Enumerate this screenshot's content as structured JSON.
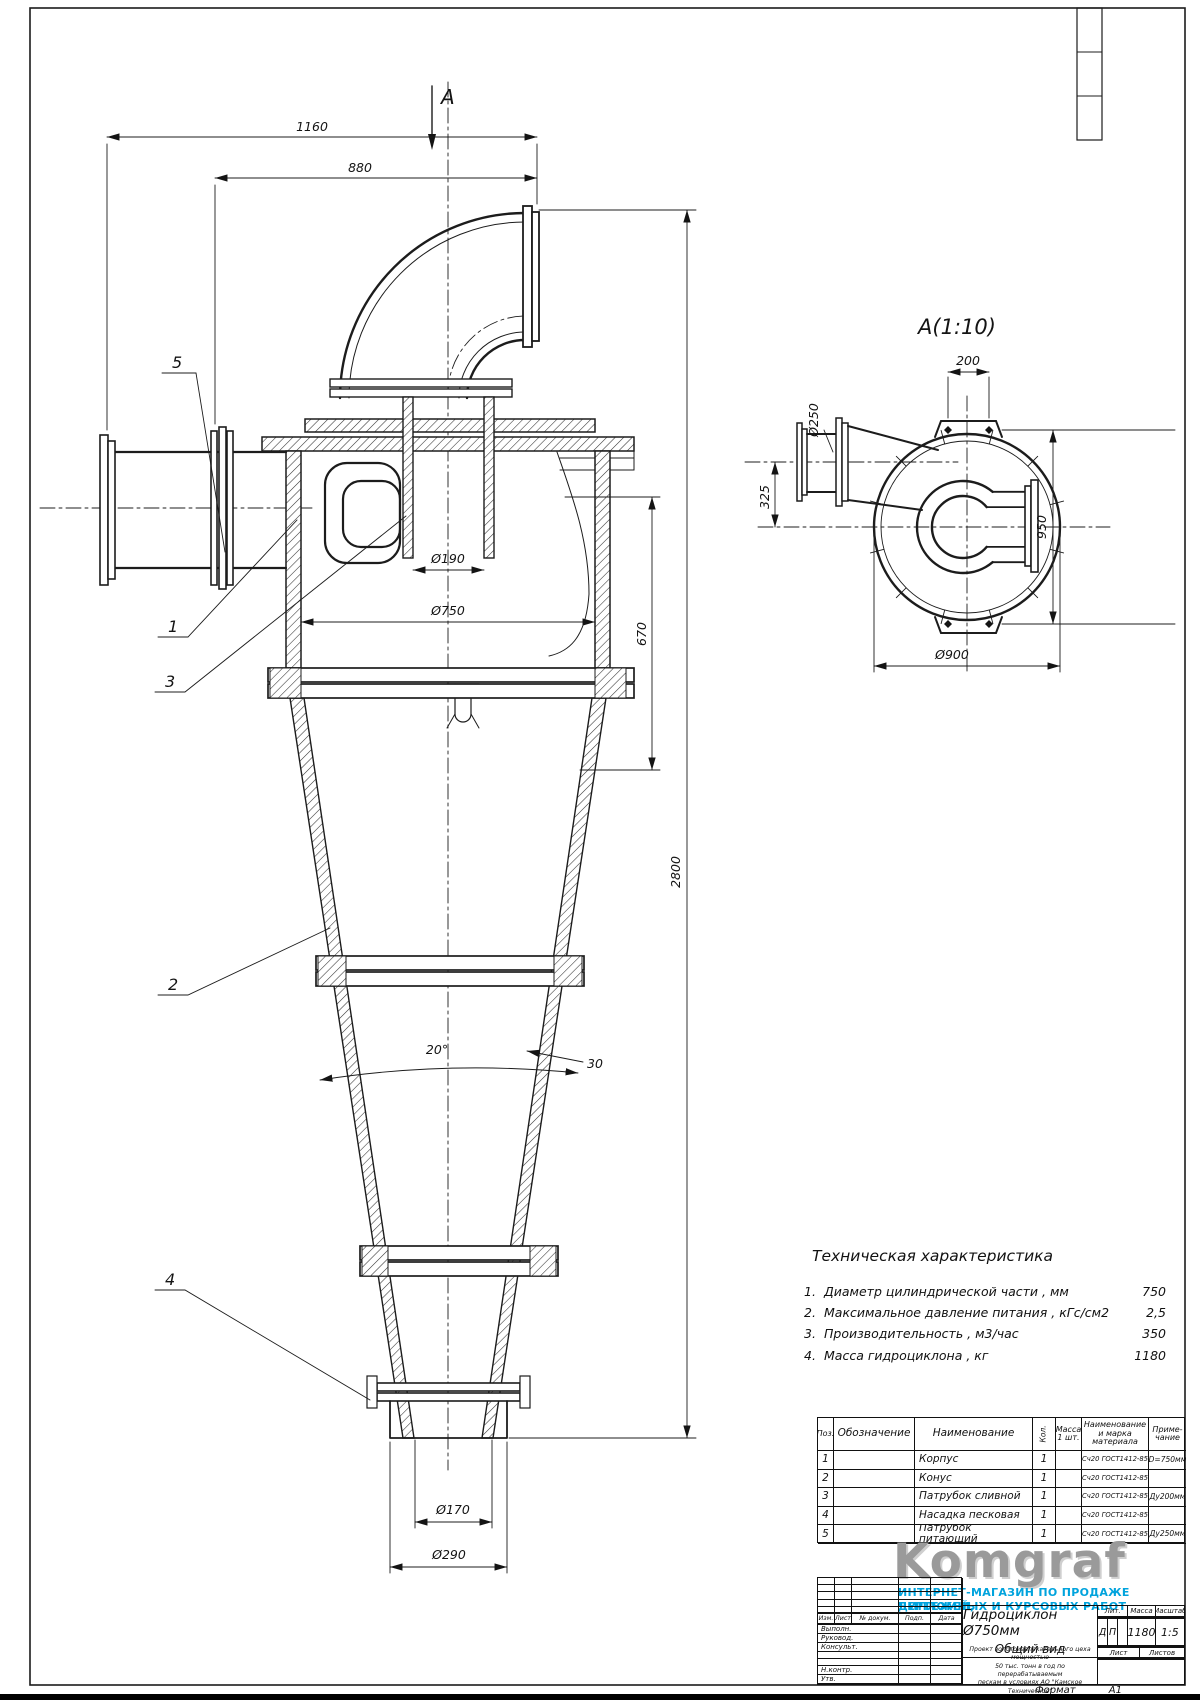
{
  "page": {
    "format_label": "Формат",
    "format_value": "А1"
  },
  "main_view": {
    "section_arrow_label": "А",
    "dims": {
      "w1160": "1160",
      "w880": "880",
      "d190": "Ø190",
      "d750": "Ø750",
      "h670": "670",
      "h2800": "2800",
      "angle": "20°",
      "t30": "30",
      "d170": "Ø170",
      "d290": "Ø290"
    },
    "callouts": {
      "c1": "1",
      "c2": "2",
      "c3": "3",
      "c4": "4",
      "c5": "5"
    }
  },
  "section_view": {
    "title": "А(1:10)",
    "dims": {
      "w200": "200",
      "d250": "Ø250",
      "h325": "325",
      "h950": "950",
      "d900": "Ø900"
    }
  },
  "tech_chars": {
    "title": "Техническая характеристика",
    "items": [
      {
        "num": "1.",
        "label": "Диаметр цилиндрической части , мм",
        "value": "750"
      },
      {
        "num": "2.",
        "label": "Максимальное давление питания , кГс/см2",
        "value": "2,5"
      },
      {
        "num": "3.",
        "label": "Производительность , м3/час",
        "value": "350"
      },
      {
        "num": "4.",
        "label": "Масса гидроциклона , кг",
        "value": "1180"
      }
    ]
  },
  "parts_table": {
    "headers": {
      "pos": "Поз.",
      "designation": "Обозначение",
      "name": "Наименование",
      "qty": "Кол.",
      "mass": "Масса 1 шт.",
      "material": "Наименование и марка материала",
      "note": "Приме- чание"
    },
    "rows": [
      {
        "pos": "1",
        "designation": "",
        "name": "Корпус",
        "qty": "1",
        "mass": "",
        "material": "Сч20 ГОСТ1412-85",
        "note": "D=750мм"
      },
      {
        "pos": "2",
        "designation": "",
        "name": "Конус",
        "qty": "1",
        "mass": "",
        "material": "Сч20 ГОСТ1412-85",
        "note": ""
      },
      {
        "pos": "3",
        "designation": "",
        "name": "Патрубок сливной",
        "qty": "1",
        "mass": "",
        "material": "Сч20 ГОСТ1412-85",
        "note": "Ду200мм"
      },
      {
        "pos": "4",
        "designation": "",
        "name": "Насадка песковая",
        "qty": "1",
        "mass": "",
        "material": "Сч20 ГОСТ1412-85",
        "note": ""
      },
      {
        "pos": "5",
        "designation": "",
        "name": "Патрубок питающий",
        "qty": "1",
        "mass": "",
        "material": "Сч20 ГОСТ1412-85",
        "note": "Ду250мм"
      }
    ]
  },
  "logo": {
    "name": "Komgraf",
    "tagline1": "ИНТЕРНЕТ-МАГАЗИН ПО ПРОДАЖЕ ЧЕРТЕЖЕЙ,",
    "tagline2": "ДИПЛОМНЫХ И КУРСОВЫХ РАБОТ",
    "brand_gray": "#9a9a9a",
    "brand_blue": "#00a3dd"
  },
  "title_block": {
    "rev_headers": [
      "Изм.",
      "Лист",
      "№ докум.",
      "Подп.",
      "Дата"
    ],
    "sig_rows": [
      "Выполн.",
      "Руковод.",
      "Консульт.",
      "",
      "",
      "Н.контр.",
      "Утв."
    ],
    "doc_title": "Гидроциклон Ø750мм",
    "doc_subtitle": "Общий вид",
    "lit_label": "Лит.",
    "mass_label": "Масса",
    "scale_label": "Масштаб",
    "lit_1": "Д",
    "lit_2": "П",
    "mass_value": "1180",
    "scale_value": "1:5",
    "sheet_label": "Лист",
    "sheets_label": "Листов",
    "org_lines": [
      "Проект золотоизвлекательного цеха мощностью",
      "50 тыс. тонн в год по перерабатываемым",
      "пескам в условиях АО \"Камское Техническое\""
    ]
  }
}
